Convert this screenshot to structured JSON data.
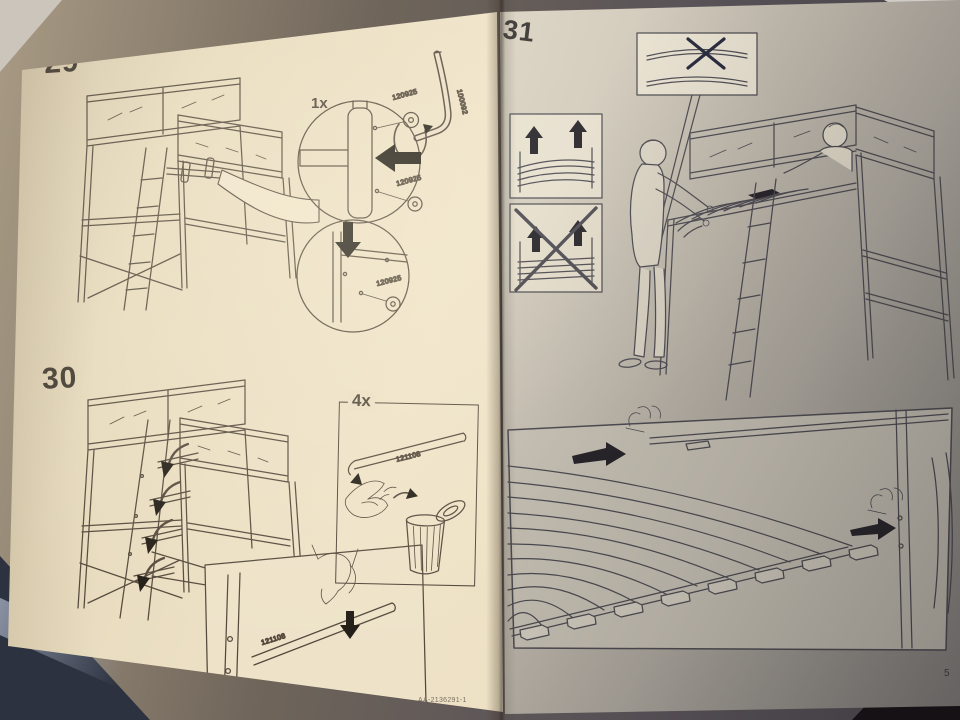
{
  "document_type": "assembly-instruction-manual-photo",
  "page_left": {
    "page_number": "52",
    "article_number": "AA-2136291-1",
    "step_29": {
      "label": "29",
      "callout_qty": "1x",
      "screw_top_label": "120925",
      "screw_mid_label": "120925",
      "screw_bottom_label": "120925",
      "allen_key_label": "100092"
    },
    "step_30": {
      "label": "30",
      "callout_qty": "4x",
      "strip_label": "121108",
      "strip_detail_label": "121108"
    }
  },
  "page_right": {
    "page_number_partial": "5",
    "step_31": {
      "label": "31"
    }
  }
}
